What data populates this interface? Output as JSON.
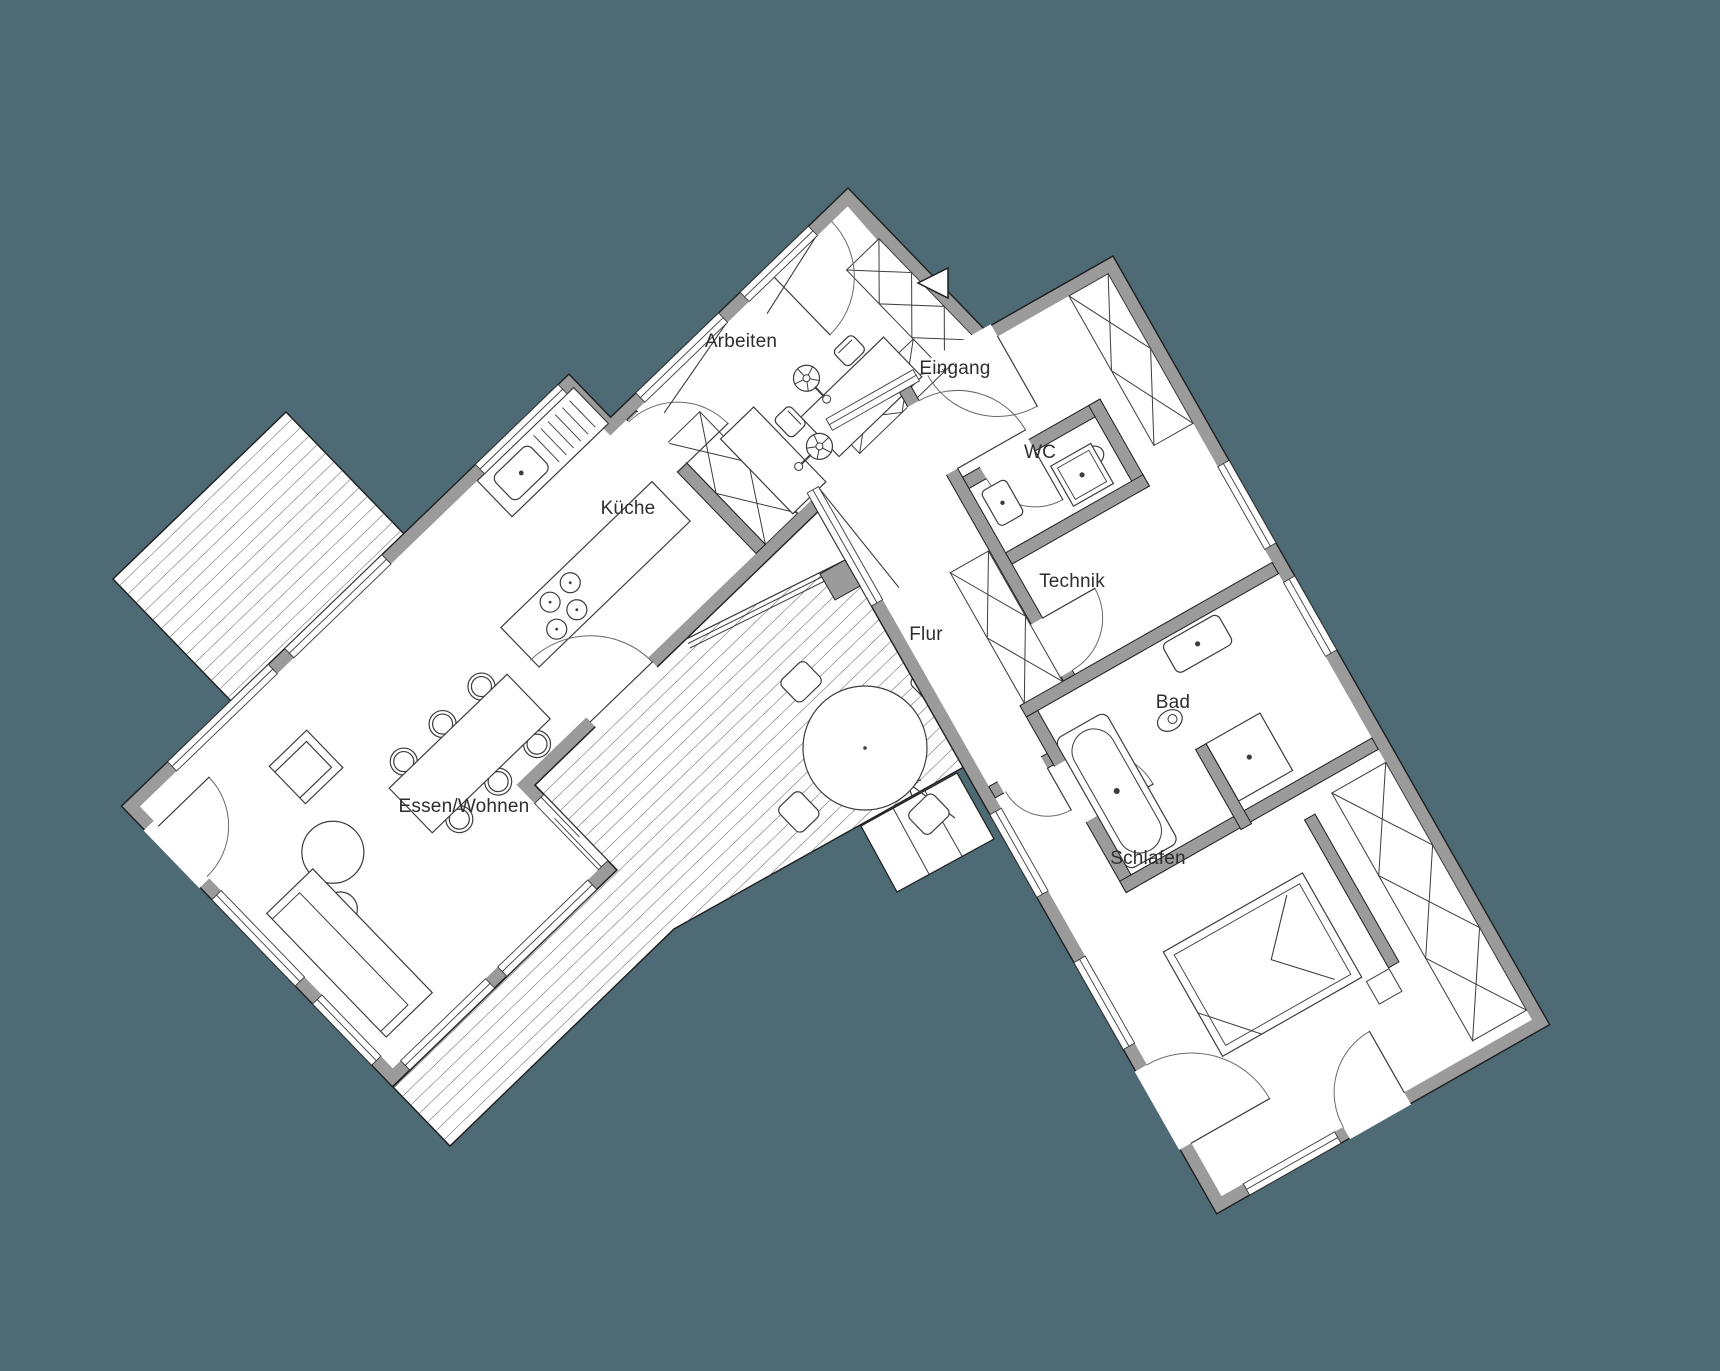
{
  "palette": {
    "background": "#4d6a75",
    "wall_gray": "#9b9b9b",
    "floor_white": "#ffffff",
    "line_dark": "#1f1f1f",
    "furniture_line": "#3c3c3c",
    "deck_hatch": "#5a5a5a"
  },
  "rooms": [
    {
      "id": "arbeiten",
      "label": "Arbeiten"
    },
    {
      "id": "eingang",
      "label": "Eingang"
    },
    {
      "id": "wc",
      "label": "WC"
    },
    {
      "id": "kueche",
      "label": "Küche"
    },
    {
      "id": "technik",
      "label": "Technik"
    },
    {
      "id": "flur",
      "label": "Flur"
    },
    {
      "id": "bad",
      "label": "Bad"
    },
    {
      "id": "essen_wohnen",
      "label": "Essen/Wohnen"
    },
    {
      "id": "schlafen",
      "label": "Schlafen"
    }
  ],
  "icons": [
    {
      "name": "entrance-arrow-icon",
      "meaning": "entrance direction marker"
    },
    {
      "name": "stairs-up-arrow-icon",
      "meaning": "deck steps direction"
    }
  ]
}
